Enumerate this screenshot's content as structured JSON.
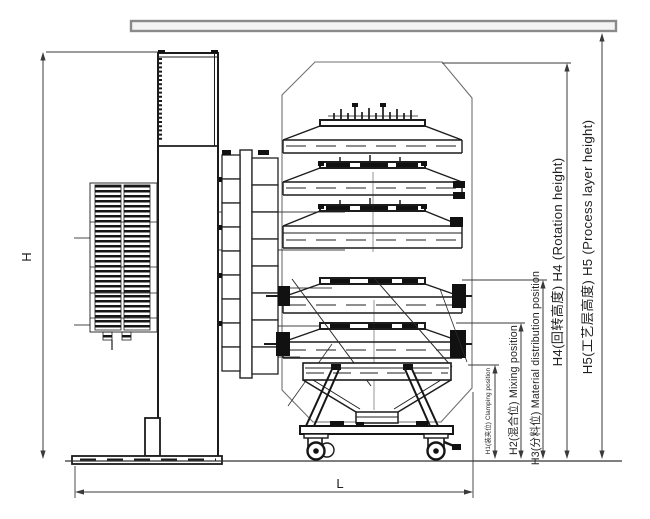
{
  "labels": {
    "h": "H",
    "l": "L",
    "h1": "H1(装夹位) Clamping position",
    "h2": "H2(混合位) Mixing position",
    "h3": "H3(分料位) Material distribution position",
    "h4": "H4(回转高度) H4 (Rotation height)",
    "h5": "H5(工艺层高度) H5 (Process layer height)"
  },
  "colors": {
    "background": "#ffffff",
    "drawing_line": "#1c1c1c",
    "dimension_line": "#3a3a3a",
    "envelope_line": "#707070",
    "ceiling_fill": "#f4f4f4"
  }
}
